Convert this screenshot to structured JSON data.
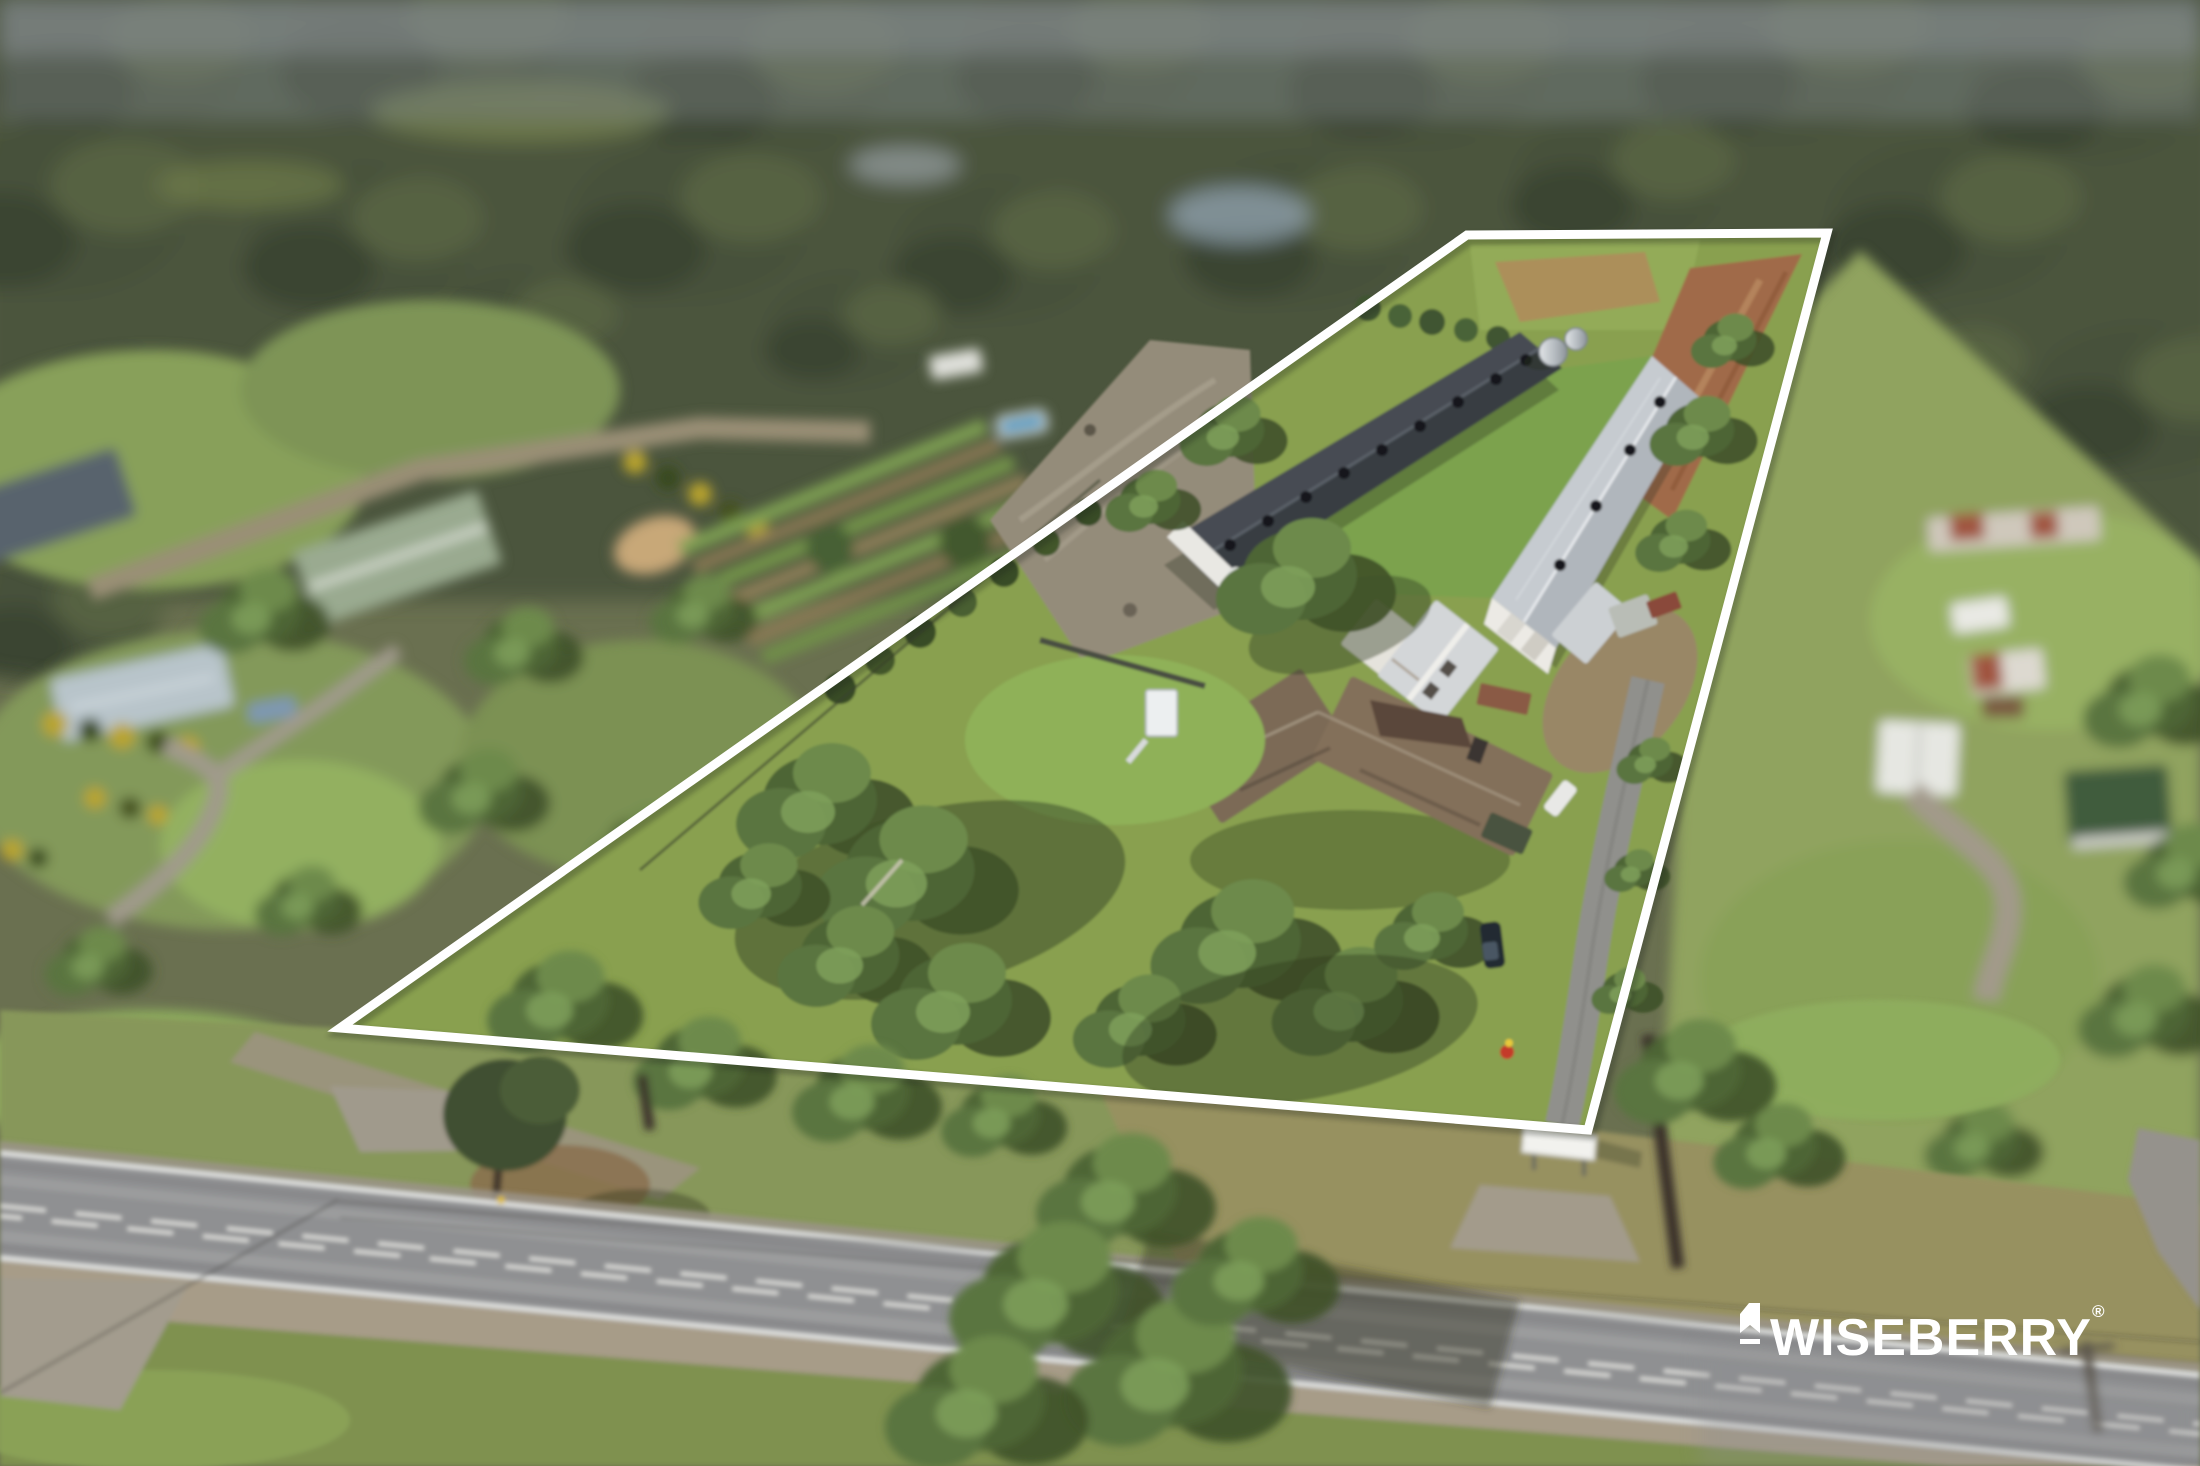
{
  "meta": {
    "media_type": "aerial-drone-photograph",
    "scene": "rural acreage property with two long poultry sheds, farmhouse, tree-lined road frontage, neighbouring paddocks and bushland"
  },
  "watermark": {
    "brand": "WISEBERRY",
    "registered": "®",
    "icon": "wiseberry-banner-icon",
    "color": "#ffffff"
  },
  "boundary": {
    "points": "1467,235 1827,233 1588,1130 340,1028",
    "stroke": "#ffffff",
    "stroke_width": 9
  },
  "palette": {
    "forest": "#47513a",
    "paddock": "#8ba25e",
    "property_grass": "#89a050",
    "gravel": "#97907e",
    "road": "#8f9092",
    "road_line": "#e9e9e7",
    "dark_shed_roof": "#43484f",
    "light_shed_roof": "#c6cbd0",
    "house_roof": "#7b6a57",
    "tilled_dirt": "#a06a48"
  }
}
